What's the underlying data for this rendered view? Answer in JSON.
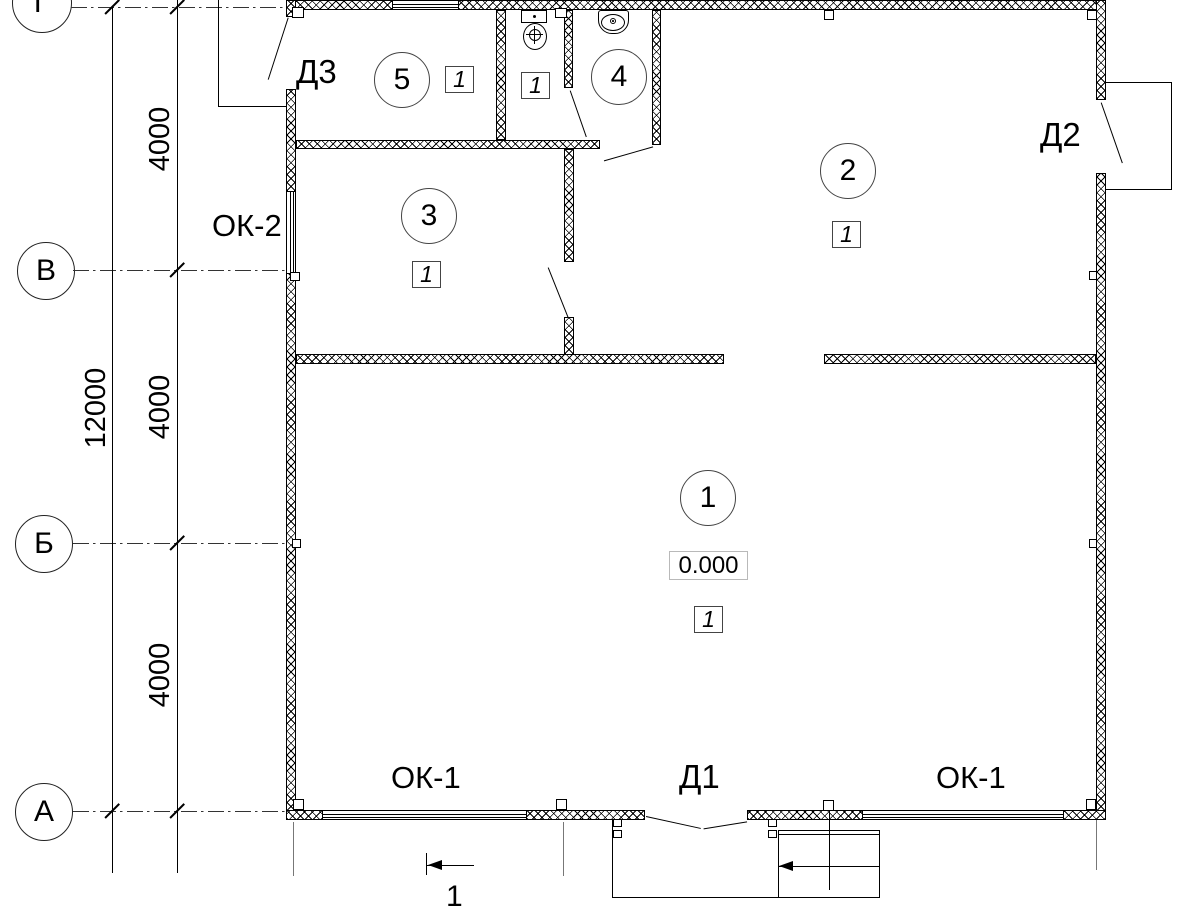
{
  "drawing": {
    "type": "floor-plan",
    "colors": {
      "ink": "#000000",
      "paper": "#ffffff"
    }
  },
  "axes": {
    "g": "Г",
    "v": "В",
    "b": "Б",
    "a": "А"
  },
  "dimensions": {
    "overall": "12000",
    "seg1": "4000",
    "seg2": "4000",
    "seg3": "4000"
  },
  "rooms": {
    "r1": {
      "number": "1",
      "finish": "1",
      "elevation": "0.000"
    },
    "r2": {
      "number": "2",
      "finish": "1"
    },
    "r3": {
      "number": "3",
      "finish": "1"
    },
    "r4": {
      "number": "4"
    },
    "r5": {
      "number": "5",
      "finish": "1"
    },
    "wc": {
      "finish": "1"
    }
  },
  "doors": {
    "d1": "Д1",
    "d2": "Д2",
    "d3": "Д3"
  },
  "windows": {
    "ok1": "ОК-1",
    "ok2": "ОК-2"
  },
  "section": {
    "mark": "1"
  }
}
